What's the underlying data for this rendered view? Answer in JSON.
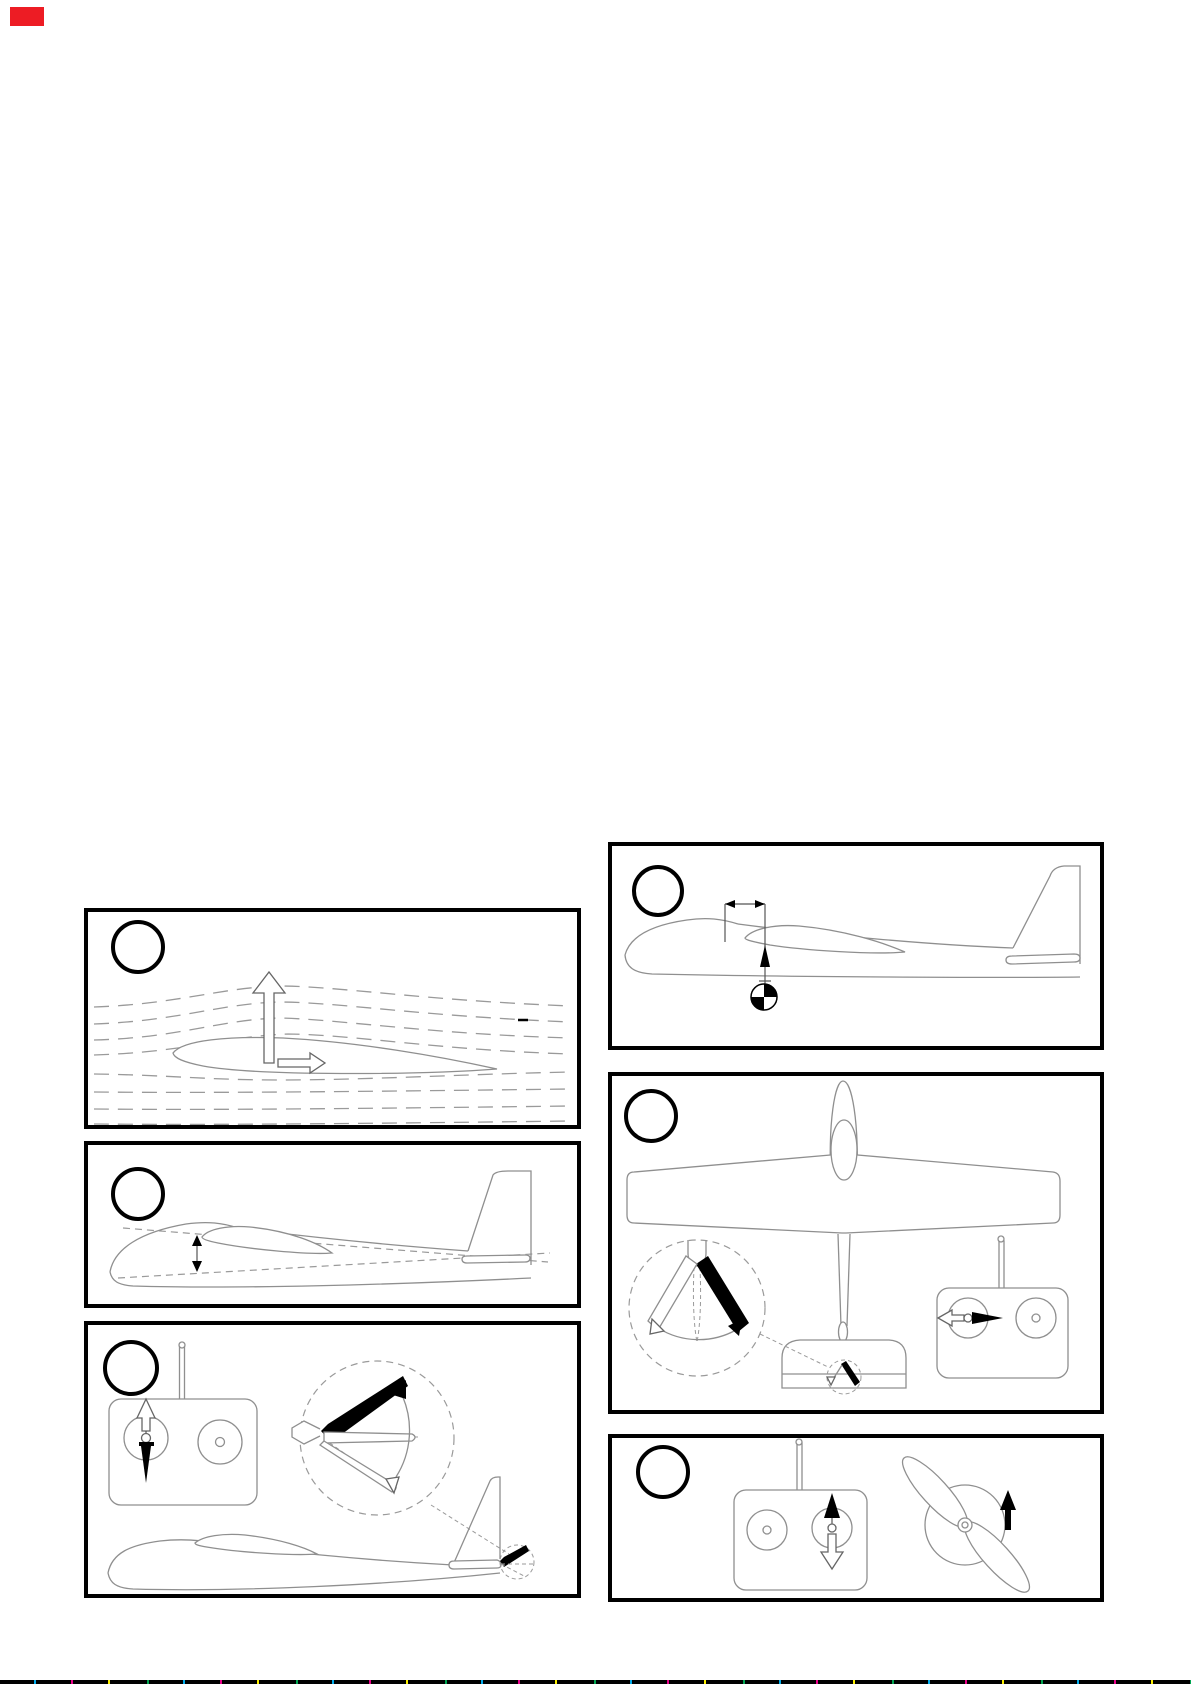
{
  "page": {
    "width_px": 1191,
    "height_px": 1685,
    "background": "#ffffff",
    "corner_mark_color": "#ed1c24",
    "bottom_rule_color": "#000000",
    "bottom_rule_speckle_colors": [
      "#00aeef",
      "#ec008c",
      "#fff200",
      "#00a651"
    ]
  },
  "panels": [
    {
      "id": "panel-a",
      "badge_label": "",
      "icon": "airfoil-airflow-lift-diagram"
    },
    {
      "id": "panel-b",
      "badge_label": "",
      "icon": "glider-side-view-incidence-diagram"
    },
    {
      "id": "panel-c",
      "badge_label": "",
      "icon": "transmitter-elevator-control-diagram"
    },
    {
      "id": "panel-d",
      "badge_label": "",
      "icon": "glider-center-of-gravity-diagram"
    },
    {
      "id": "panel-e",
      "badge_label": "",
      "icon": "glider-top-view-rudder-control-diagram"
    },
    {
      "id": "panel-f",
      "badge_label": "",
      "icon": "transmitter-throttle-propeller-diagram"
    }
  ],
  "colors": {
    "line_art": "#8f8f8f",
    "fills": "#000000",
    "panel_border": "#000000"
  }
}
